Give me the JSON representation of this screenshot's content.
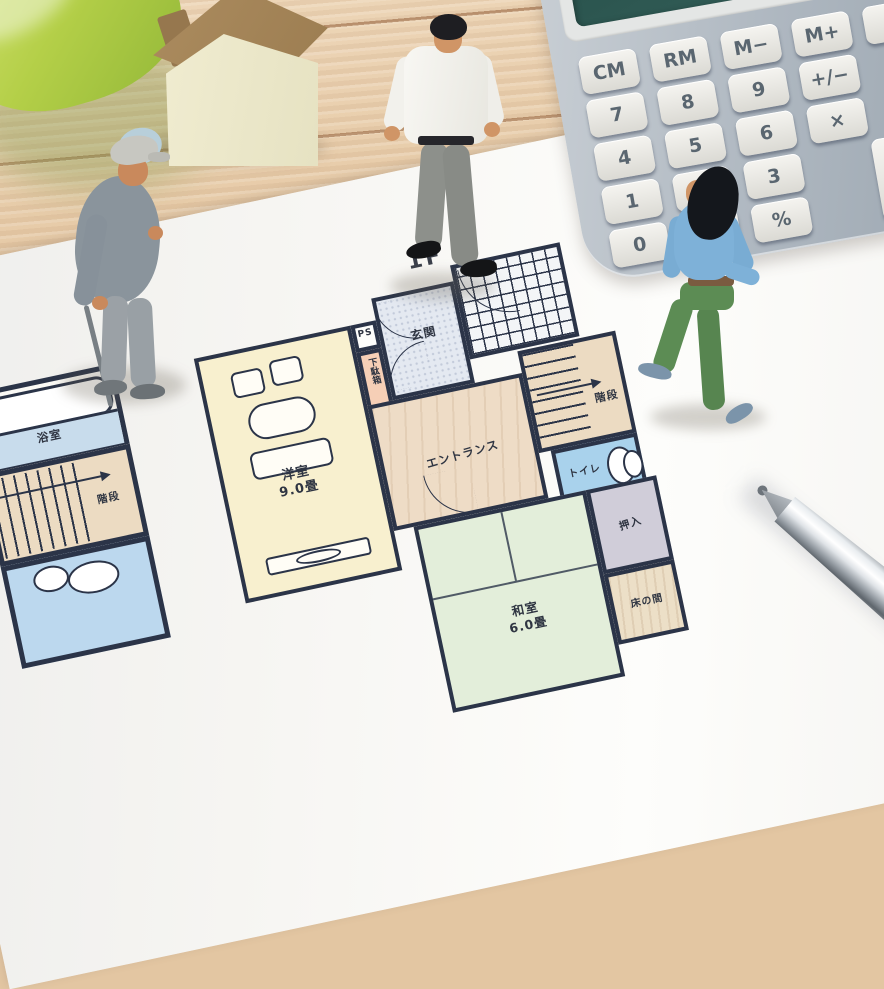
{
  "floorplan": {
    "title": "1F",
    "rooms": {
      "western_room": {
        "label": "洋室",
        "size": "9.0畳"
      },
      "japanese_room": {
        "label": "和室",
        "size": "6.0畳"
      },
      "genkan": {
        "label": "玄関"
      },
      "shoe_cabinet": {
        "label": "下駄箱"
      },
      "pipe_shaft": {
        "label": "PS"
      },
      "entrance_hall": {
        "label": "エントランス"
      },
      "stairs_right": {
        "label": "階段"
      },
      "stairs_left": {
        "label": "階段"
      },
      "toilet": {
        "label": "トイレ"
      },
      "closet": {
        "label": "押入"
      },
      "tokonoma": {
        "label": "床の間"
      },
      "bathroom": {
        "label": "浴室"
      }
    },
    "wall_color": "#2b3448"
  },
  "calculator": {
    "keys": {
      "cm": "CM",
      "rm": "RM",
      "m_minus": "M−",
      "m_plus": "M+",
      "on_cc": "ON\nC-C",
      "k7": "7",
      "k8": "8",
      "k9": "9",
      "sign": "+/−",
      "k4": "4",
      "k5": "5",
      "k6": "6",
      "mul": "×",
      "k1": "1",
      "k2": "2",
      "k3": "3",
      "plus": "+",
      "k0": "0",
      "dot": "·",
      "percent": "%"
    },
    "colors": {
      "body": "#aeb7c0",
      "display": "#2e564e",
      "key": "#efeeea",
      "key_text": "#5a6670"
    }
  },
  "palette": {
    "wood": "#e5c8a4",
    "paper": "#f7f6f3",
    "leaf": "#b4cf48",
    "house_roof": "#9b7c50",
    "house_body": "#ece8cb",
    "old_man_outfit": "#8a949c",
    "man_shirt": "#f5f4ef",
    "man_pants": "#8d908b",
    "woman_top": "#7eb1d8",
    "woman_pants": "#5c8c54",
    "pen_chrome": "#dfe3e7"
  }
}
